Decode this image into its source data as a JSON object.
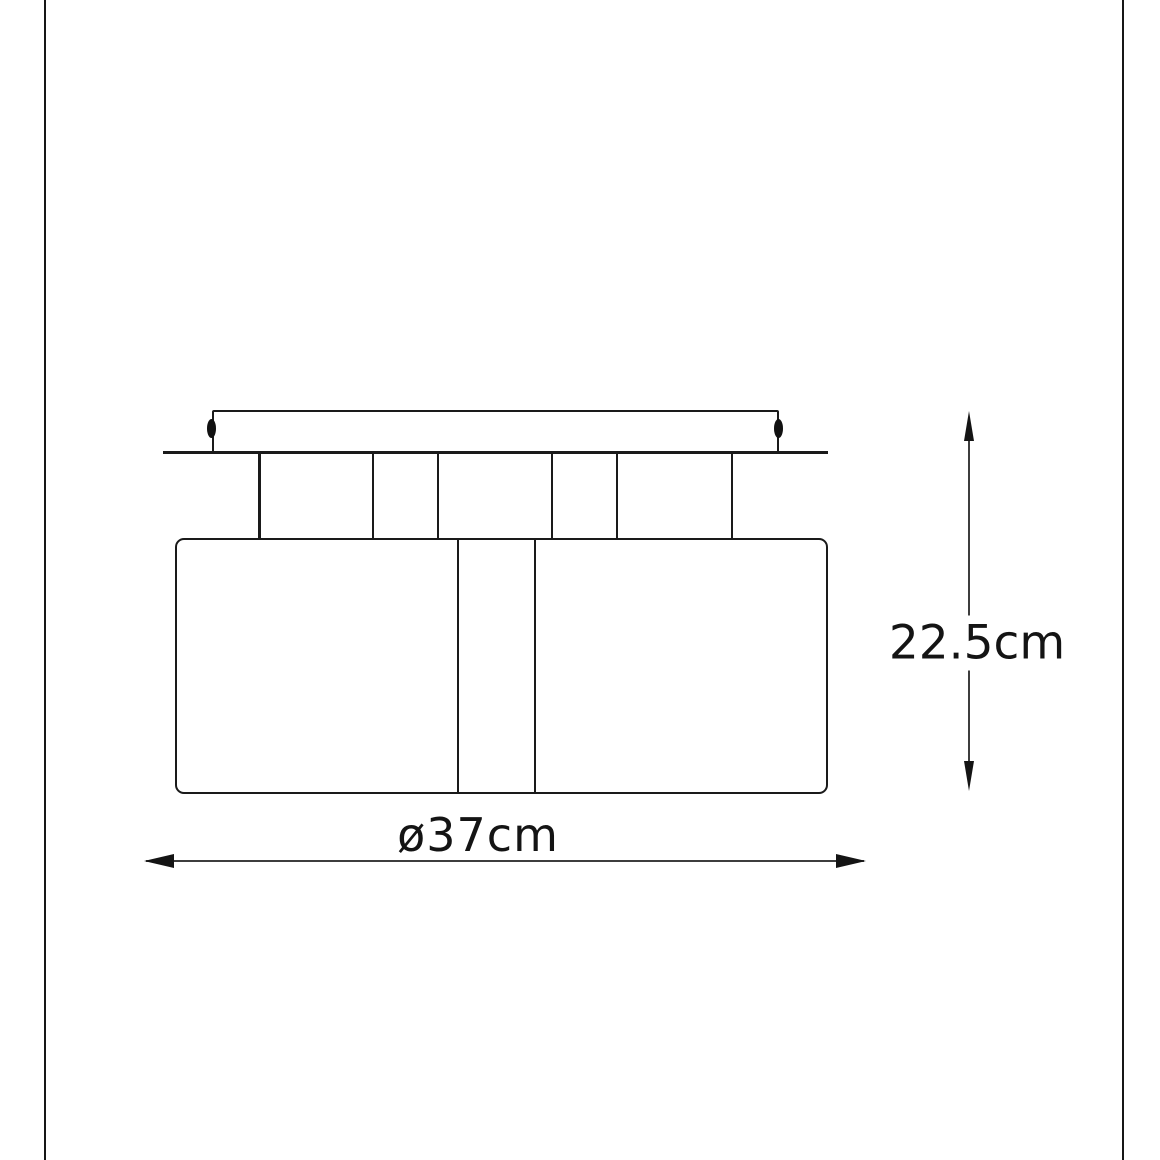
{
  "drawing": {
    "type": "product-dimension-diagram",
    "subject": "two-shade ceiling light fixture, side elevation",
    "dimensions": {
      "height_label": "22.5cm",
      "height_cm": 22.5,
      "diameter_label": "ø37cm",
      "diameter_cm": 37
    },
    "colors": {
      "background": "#ffffff",
      "line": "#1a1a1a",
      "dimension_line": "#3d3d3d",
      "text": "#141414"
    }
  }
}
